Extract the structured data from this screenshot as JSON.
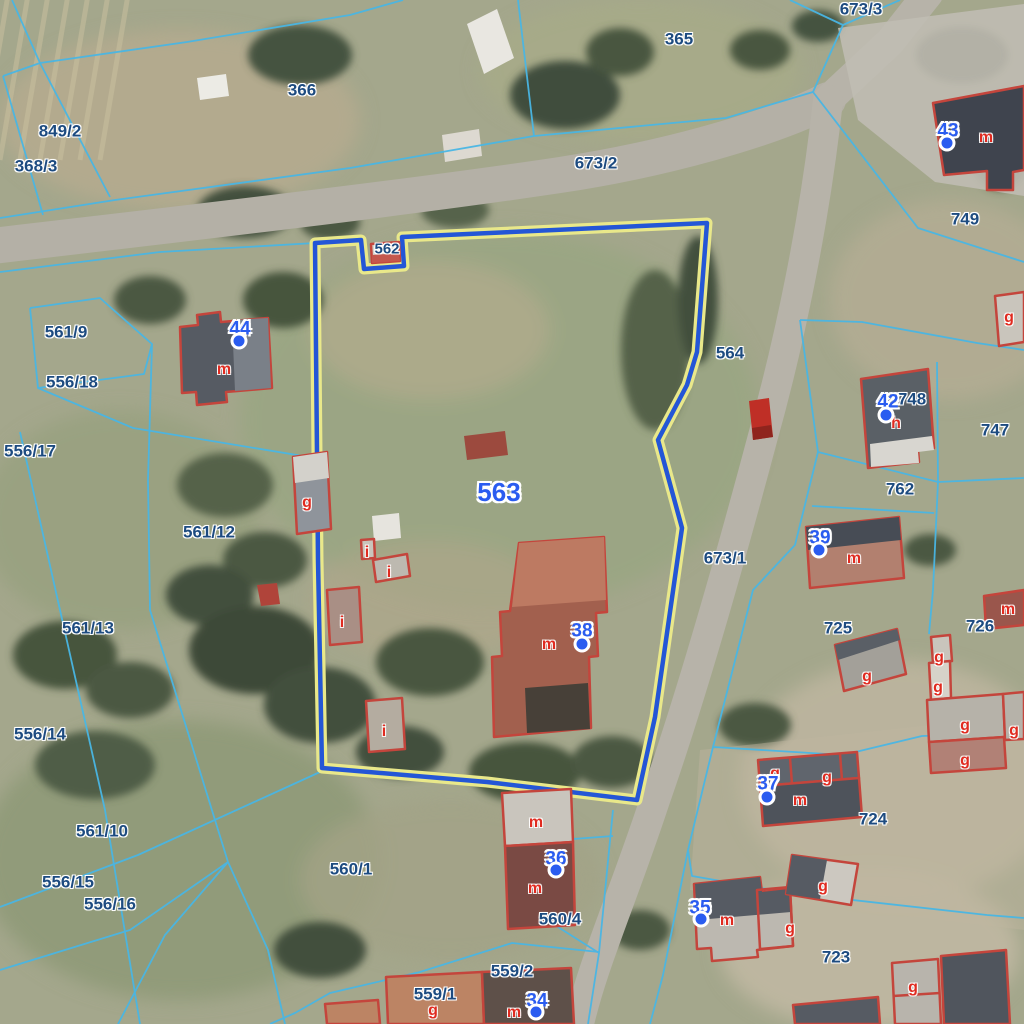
{
  "map": {
    "type": "cadastral-parcel-map-over-aerial-imagery",
    "selected_parcel": "563",
    "colors": {
      "parcel_line": "#49b6e4",
      "parcel_label": "#1d4b80",
      "selected_parcel_label": "#2a5cf0",
      "address_label": "#2a5cf0",
      "address_dot": "#2a5cf0",
      "building_outline": "#c4453c",
      "building_letter": "#e02b20",
      "selection_line": "#2456d6",
      "selection_halo": "#e9e88a"
    },
    "parcel_labels": [
      {
        "t": "366",
        "x": 302,
        "y": 90
      },
      {
        "t": "365",
        "x": 679,
        "y": 39
      },
      {
        "t": "673/3",
        "x": 861,
        "y": 9
      },
      {
        "t": "673/2",
        "x": 596,
        "y": 163
      },
      {
        "t": "849/2",
        "x": 60,
        "y": 131
      },
      {
        "t": "368/3",
        "x": 36,
        "y": 166
      },
      {
        "t": "749",
        "x": 965,
        "y": 219
      },
      {
        "t": "561/9",
        "x": 66,
        "y": 332
      },
      {
        "t": "556/18",
        "x": 72,
        "y": 382
      },
      {
        "t": "564",
        "x": 730,
        "y": 353
      },
      {
        "t": "556/17",
        "x": 30,
        "y": 451
      },
      {
        "t": "561/12",
        "x": 209,
        "y": 532
      },
      {
        "t": "748",
        "x": 912,
        "y": 399
      },
      {
        "t": "747",
        "x": 995,
        "y": 430
      },
      {
        "t": "762",
        "x": 900,
        "y": 489
      },
      {
        "t": "673/1",
        "x": 725,
        "y": 558
      },
      {
        "t": "725",
        "x": 838,
        "y": 628
      },
      {
        "t": "726",
        "x": 980,
        "y": 626
      },
      {
        "t": "561/13",
        "x": 88,
        "y": 628
      },
      {
        "t": "556/14",
        "x": 40,
        "y": 734
      },
      {
        "t": "724",
        "x": 873,
        "y": 819
      },
      {
        "t": "561/10",
        "x": 102,
        "y": 831
      },
      {
        "t": "556/15",
        "x": 68,
        "y": 882
      },
      {
        "t": "556/16",
        "x": 110,
        "y": 904
      },
      {
        "t": "560/1",
        "x": 351,
        "y": 869
      },
      {
        "t": "560/4",
        "x": 560,
        "y": 919
      },
      {
        "t": "559/2",
        "x": 512,
        "y": 971
      },
      {
        "t": "559/1",
        "x": 435,
        "y": 994
      },
      {
        "t": "723",
        "x": 836,
        "y": 957
      },
      {
        "t": "562",
        "x": 387,
        "y": 249,
        "s": 15
      }
    ],
    "selected_label": {
      "t": "563",
      "x": 499,
      "y": 492
    },
    "address_points": [
      {
        "t": "43",
        "x": 948,
        "y": 131,
        "dx": 947,
        "dy": 143
      },
      {
        "t": "44",
        "x": 240,
        "y": 329,
        "dx": 239,
        "dy": 341
      },
      {
        "t": "42",
        "x": 888,
        "y": 402,
        "dx": 886,
        "dy": 415
      },
      {
        "t": "39",
        "x": 820,
        "y": 538,
        "dx": 819,
        "dy": 550
      },
      {
        "t": "38",
        "x": 582,
        "y": 631,
        "dx": 582,
        "dy": 644
      },
      {
        "t": "37",
        "x": 768,
        "y": 784,
        "dx": 767,
        "dy": 797
      },
      {
        "t": "36",
        "x": 556,
        "y": 859,
        "dx": 556,
        "dy": 870
      },
      {
        "t": "35",
        "x": 700,
        "y": 908,
        "dx": 701,
        "dy": 919
      },
      {
        "t": "34",
        "x": 537,
        "y": 1001,
        "dx": 536,
        "dy": 1012
      }
    ],
    "building_letters": [
      {
        "t": "m",
        "x": 986,
        "y": 138
      },
      {
        "t": "m",
        "x": 224,
        "y": 370
      },
      {
        "t": "g",
        "x": 307,
        "y": 503
      },
      {
        "t": "g",
        "x": 1009,
        "y": 318
      },
      {
        "t": "i",
        "x": 367,
        "y": 553
      },
      {
        "t": "i",
        "x": 389,
        "y": 573
      },
      {
        "t": "i",
        "x": 342,
        "y": 623
      },
      {
        "t": "i",
        "x": 384,
        "y": 732
      },
      {
        "t": "m",
        "x": 549,
        "y": 645
      },
      {
        "t": "h",
        "x": 896,
        "y": 424
      },
      {
        "t": "m",
        "x": 854,
        "y": 559
      },
      {
        "t": "m",
        "x": 1008,
        "y": 610
      },
      {
        "t": "g",
        "x": 867,
        "y": 677
      },
      {
        "t": "g",
        "x": 939,
        "y": 658
      },
      {
        "t": "g",
        "x": 938,
        "y": 688
      },
      {
        "t": "g",
        "x": 965,
        "y": 726
      },
      {
        "t": "g",
        "x": 1014,
        "y": 731
      },
      {
        "t": "g",
        "x": 965,
        "y": 761
      },
      {
        "t": "g",
        "x": 775,
        "y": 774
      },
      {
        "t": "g",
        "x": 827,
        "y": 778
      },
      {
        "t": "m",
        "x": 800,
        "y": 801
      },
      {
        "t": "m",
        "x": 536,
        "y": 823
      },
      {
        "t": "m",
        "x": 535,
        "y": 889
      },
      {
        "t": "m",
        "x": 727,
        "y": 921
      },
      {
        "t": "g",
        "x": 790,
        "y": 929
      },
      {
        "t": "g",
        "x": 823,
        "y": 887
      },
      {
        "t": "g",
        "x": 913,
        "y": 988
      },
      {
        "t": "g",
        "x": 433,
        "y": 1011
      },
      {
        "t": "m",
        "x": 514,
        "y": 1013
      }
    ]
  }
}
